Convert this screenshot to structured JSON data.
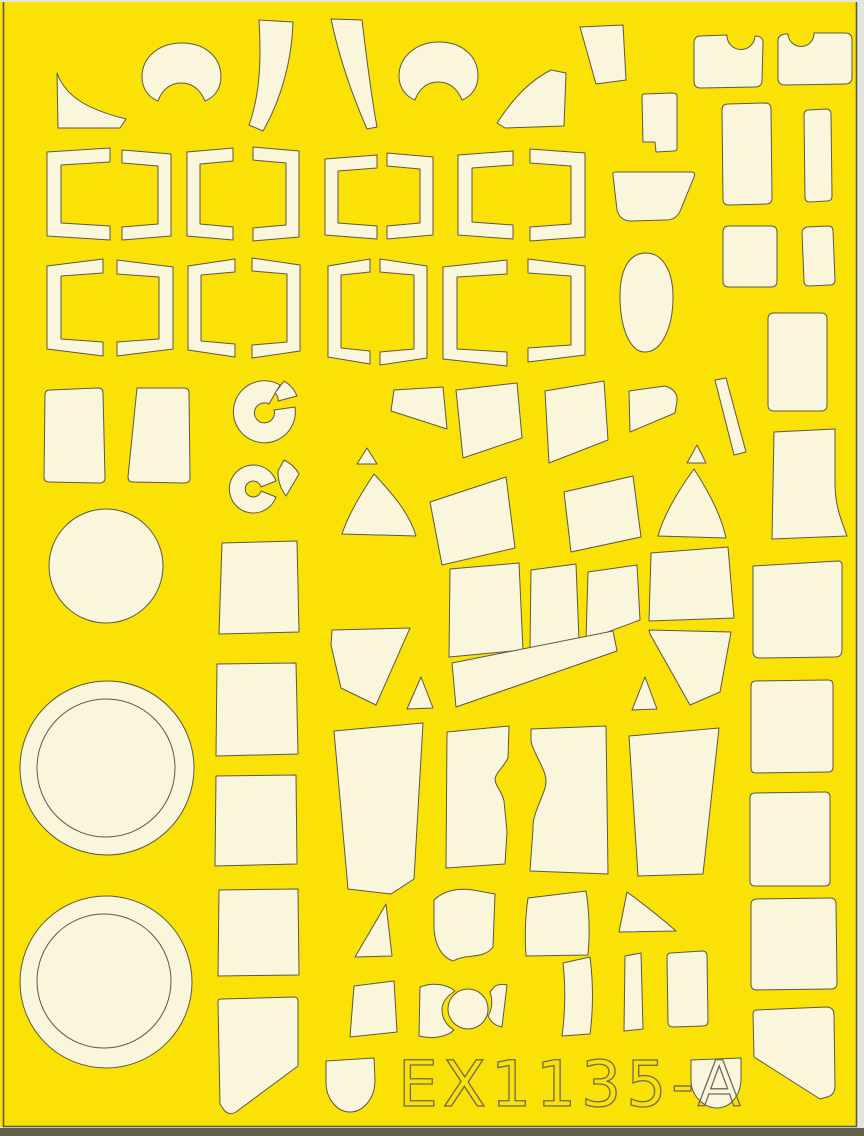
{
  "sheet": {
    "code": "EX1135-A"
  },
  "colors": {
    "scan_bg": "#E4E4E0",
    "sheet_yellow": "#FAE206",
    "mask_cream": "#FAF6DC",
    "outline": "#5C584A",
    "bottom_band": "#63614E",
    "text_outline": "#6E6A5C"
  },
  "label": {
    "x": 398,
    "y": 1106,
    "size": 63,
    "spacing": 5,
    "stroke_width": 1.3
  },
  "shapes": [
    {
      "name": "mask-fin-left",
      "d": "M57,73 C66,98 90,110 126,119 L120,128 L58,128 Z"
    },
    {
      "name": "mask-kidney-1",
      "d": "M142,77 C142,57 159,43 182,43 C205,43 221,57 221,77 C221,88 215,97 205,101 C200,89 192,83 181,83 C170,83 162,90 158,101 C148,97 142,88 142,77 Z"
    },
    {
      "name": "mask-crescent-1",
      "d": "M259,20 L293,22 C292,60 281,100 263,131 L249,125 C261,92 261,55 259,20 Z"
    },
    {
      "name": "mask-crescent-2",
      "d": "M331,19 L362,20 C367,62 372,100 377,127 L367,129 C353,97 339,57 331,19 Z"
    },
    {
      "name": "mask-kidney-2",
      "d": "M399,76 C399,57 416,42 439,42 C462,42 478,56 478,76 C478,87 472,96 462,100 C457,88 449,82 438,82 C427,82 419,89 415,100 C405,96 399,87 399,76 Z"
    },
    {
      "name": "mask-fin-right",
      "d": "M497,123 C516,94 533,79 551,70 L566,73 L564,126 L505,128 Z"
    },
    {
      "name": "mask-trapezoid-tr",
      "d": "M580,27 L623,25 L626,80 L596,84 Z"
    },
    {
      "name": "mask-notch-rect-1",
      "d": "M701,36 L727,35 A14,14 0 0 0 755,36 Q763,36 763,43 L762,80 Q762,87 755,87 L701,88 Q694,88 694,81 L694,43 Q694,36 701,36 Z"
    },
    {
      "name": "mask-notch-rect-2",
      "d": "M785,34 Q778,35 778,41 L778,78 Q778,85 785,85 L845,84 Q852,84 852,77 L852,40 Q852,33 845,33 L814,33 A13,13 0 0 1 788,34 Z"
    },
    {
      "name": "mask-rect-notch",
      "d": "M644,94 L672,93 Q677,93 677,96 L677,148 Q677,151 674,151 L656,152 L655,142 L643,142 L642,97 Q642,94 644,94 Z"
    },
    {
      "name": "mask-tall-rrect-1",
      "d": "M728,104 Q722,104 722,110 L723,199 Q723,205 729,205 L766,204 Q772,204 772,198 L771,109 Q771,103 765,103 Z"
    },
    {
      "name": "mask-narrow-rrect-1",
      "d": "M809,110 Q804,110 804,115 L805,197 Q805,202 810,202 L827,201 Q832,201 832,196 L831,114 Q831,109 826,109 Z"
    },
    {
      "name": "mask-trapezoid-mid",
      "d": "M613,175 Q612,172 616,172 L691,172 Q696,172 694,177 L681,209 Q677,220 666,220 L631,221 Q620,221 617,210 Z"
    },
    {
      "name": "mask-rsquare-1",
      "d": "M729,226 Q723,226 723,232 L723,281 Q723,287 729,287 L771,287 Q777,287 777,281 L777,232 Q777,226 771,226 Z"
    },
    {
      "name": "mask-narrow-rrect-2",
      "d": "M807,227 Q802,228 802,233 L804,281 Q804,286 809,286 L830,285 Q835,285 835,280 L833,231 Q833,226 828,226 Z"
    },
    {
      "name": "mask-egg",
      "d": "M646,253 C662,253 673,270 673,297 C673,327 662,352 645,352 C629,352 620,326 620,296 C620,268 630,253 646,253 Z"
    },
    {
      "name": "mask-big-rrect-right",
      "d": "M774,313 Q768,313 768,319 L768,405 Q768,411 774,411 L821,411 Q827,411 827,405 L827,319 Q827,313 821,313 Z"
    },
    {
      "name": "mask-rtrap-1",
      "d": "M50,390 Q45,390 45,395 L44,477 Q44,482 49,482 L99,483 Q105,483 105,478 L103,393 Q103,388 98,388 Z"
    },
    {
      "name": "mask-rtrap-2",
      "d": "M137,388 L184,388 Q189,388 189,393 L190,478 Q190,483 184,483 L133,482 Q128,482 128,477 Z"
    },
    {
      "name": "mask-spinner1-ring",
      "d": "M295,407 A31,31 0 1 1 280,385 L269,404 A10,10 0 1 0 274,410 Z"
    },
    {
      "name": "mask-spinner1-wedge",
      "d": "M284,381 A30,30 0 0 1 297,396 L278,401 A9,9 0 0 0 275,393 Z"
    },
    {
      "name": "mask-spinner2-ring",
      "d": "M276,497 A24,24 0 1 1 276,481 L261,487 A8,8 0 1 0 261,491 Z"
    },
    {
      "name": "mask-spinner2-wedge",
      "d": "M284,460 A34,34 0 0 1 299,474 L286,496 A40,40 0 0 1 278,471 Z"
    },
    {
      "name": "mask-square-1",
      "d": "M222,543 L297,541 L299,632 L219,634 Z"
    },
    {
      "name": "mask-square-2",
      "d": "M217,664 L296,663 L298,754 L216,756 Z"
    },
    {
      "name": "mask-square-3",
      "d": "M216,776 L296,775 L297,864 L215,866 Z"
    },
    {
      "name": "mask-square-4",
      "d": "M219,890 L298,889 L299,975 L218,976 Z"
    },
    {
      "name": "mask-pennant-left",
      "d": "M221,999 L294,997 Q298,997 298,1001 L298,1066 L236,1112 Q229,1116 224,1110 L220,1104 L218,1002 Q218,999 221,999 Z"
    },
    {
      "name": "mask-poly-flag",
      "d": "M391,411 L394,390 L443,387 L447,429 Z"
    },
    {
      "name": "mask-poly-a",
      "d": "M456,390 L517,383 L522,438 L463,458 Z"
    },
    {
      "name": "mask-poly-b",
      "d": "M545,391 L604,381 L608,440 L549,463 Z"
    },
    {
      "name": "mask-tri-1",
      "d": "M367,448 L377,464 L357,464 Z"
    },
    {
      "name": "mask-cone-1",
      "d": "M374,474 C362,492 348,515 342,534 L416,536 C409,512 390,491 374,474 Z"
    },
    {
      "name": "mask-poly-c",
      "d": "M430,502 L506,477 L515,548 L442,565 Z"
    },
    {
      "name": "mask-poly-d",
      "d": "M564,492 L633,476 L641,537 L571,552 Z"
    },
    {
      "name": "mask-tri-2",
      "d": "M697,445 L706,463 L687,463 Z"
    },
    {
      "name": "mask-cone-2",
      "d": "M694,469 C680,488 664,514 658,536 L726,538 C721,514 707,489 694,469 Z"
    },
    {
      "name": "mask-wedge-right",
      "d": "M629,391 L665,386 Q678,390 677,401 L675,413 L630,432 Z"
    },
    {
      "name": "mask-sliver-diagonal",
      "d": "M715,380 L726,378 L746,452 L734,455 Z"
    },
    {
      "name": "mask-boot",
      "d": "M774,432 L835,429 L835,483 C835,507 842,522 847,536 L772,539 Z"
    },
    {
      "name": "mask-quad-a",
      "d": "M450,569 L519,563 L523,650 L449,657 Z"
    },
    {
      "name": "mask-quad-b",
      "d": "M531,570 L576,564 L579,640 L530,648 Z"
    },
    {
      "name": "mask-quad-c",
      "d": "M588,572 L637,565 L640,620 L586,640 Z"
    },
    {
      "name": "mask-quad-d",
      "d": "M651,553 L728,547 L734,618 L649,621 Z"
    },
    {
      "name": "mask-band-e",
      "d": "M452,663 L613,631 L617,651 L456,707 Z"
    },
    {
      "name": "mask-pentagon-left",
      "d": "M332,630 L410,628 L376,705 L341,688 L331,645 Z"
    },
    {
      "name": "mask-tri-3",
      "d": "M421,677 L433,708 L407,709 Z"
    },
    {
      "name": "mask-pentagon-right",
      "d": "M649,630 L731,632 L720,692 L690,705 L650,634 Z"
    },
    {
      "name": "mask-tri-4",
      "d": "M645,677 L657,709 L632,710 Z"
    },
    {
      "name": "mask-bigquad-1",
      "d": "M334,731 L423,723 L414,879 L391,894 L348,889 Z"
    },
    {
      "name": "mask-waist-1",
      "d": "M447,732 L509,726 L508,758 C503,768 496,772 495,779 C495,786 502,791 504,801 L507,832 L505,864 L446,868 Z"
    },
    {
      "name": "mask-waist-2",
      "d": "M531,729 L606,726 L608,874 L530,871 L533,829 C532,812 546,794 546,781 C546,769 533,753 531,741 Z"
    },
    {
      "name": "mask-bigquad-2",
      "d": "M629,736 L719,728 L703,874 L638,876 Z"
    },
    {
      "name": "mask-rsq-a",
      "d": "M753,566 L838,561 Q842,561 842,565 L842,650 Q842,657 835,657 L760,658 Q753,658 753,651 Z"
    },
    {
      "name": "mask-rsq-b",
      "d": "M756,681 Q751,681 751,686 L751,768 Q751,773 756,773 L828,772 Q833,772 833,767 L833,685 Q833,680 828,680 Z"
    },
    {
      "name": "mask-rsq-c",
      "d": "M755,793 Q750,793 750,798 L750,881 Q750,886 755,886 L825,886 Q830,886 830,881 L830,797 Q830,792 825,792 Z"
    },
    {
      "name": "mask-tri-b1",
      "d": "M386,904 L392,956 L355,957 Z"
    },
    {
      "name": "mask-quad-b1",
      "d": "M434,900 C444,890 459,888 473,890 L495,894 L493,947 C483,960 467,953 453,961 C441,957 435,944 434,929 Z"
    },
    {
      "name": "mask-quad-b2",
      "d": "M528,898 L586,891 Q591,922 588,955 L526,956 Q524,925 528,898 Z"
    },
    {
      "name": "mask-tri-b2",
      "d": "M627,892 C642,903 660,917 676,931 L619,932 Z"
    },
    {
      "name": "mask-quad-b3",
      "d": "M354,986 L394,981 L397,1032 L350,1037 Z"
    },
    {
      "name": "mask-bite-left",
      "d": "M420,987 C432,982 447,984 455,991 C447,996 442,1002 442,1010 C442,1018 446,1025 454,1030 C446,1038 430,1039 419,1036 Z"
    },
    {
      "name": "mask-bite-right",
      "d": "M495,986 C500,984 504,984 507,985 L502,1027 C496,1026 491,1022 488,1016 C492,1010 493,1000 490,992 Z"
    },
    {
      "name": "mask-strip-vertical",
      "d": "M625,956 L641,953 L643,1029 L624,1031 Z"
    },
    {
      "name": "mask-rquad-b",
      "d": "M671,953 Q667,953 667,957 L668,1022 Q668,1027 673,1027 L703,1026 Q708,1026 708,1021 L707,956 Q707,951 702,951 L671,953 Z"
    },
    {
      "name": "mask-curved-quad",
      "d": "M563,963 L590,957 Q595,997 590,1034 L562,1036 Q567,999 563,963 Z"
    },
    {
      "name": "mask-big-rsq-br",
      "d": "M757,899 Q751,899 751,905 L751,984 Q751,990 757,990 L831,989 Q837,989 837,983 L836,904 Q836,898 830,898 Z"
    },
    {
      "name": "mask-pennant-right",
      "d": "M757,1010 L826,1007 Q834,1007 834,1015 L835,1086 Q835,1095 827,1097 L820,1099 L754,1057 L753,1014 Q753,1010 757,1010 Z"
    },
    {
      "name": "mask-dome-1",
      "d": "M326,1061 L374,1058 L375,1080 C375,1100 362,1112 350,1112 C338,1112 326,1100 326,1082 Z"
    },
    {
      "name": "mask-dome-2",
      "d": "M691,1060 L741,1058 L741,1078 C741,1097 729,1108 717,1108 C704,1108 691,1096 691,1080 Z"
    }
  ],
  "circles": [
    {
      "name": "mask-circle-small",
      "cx": 106,
      "cy": 566,
      "r": 57,
      "stroke_only": false
    },
    {
      "name": "mask-ring-1-outer",
      "cx": 107,
      "cy": 768,
      "r": 87,
      "stroke_only": false
    },
    {
      "name": "mask-ring-1-inner",
      "cx": 106,
      "cy": 768,
      "r": 69,
      "stroke_only": true
    },
    {
      "name": "mask-ring-2-outer",
      "cx": 106,
      "cy": 982,
      "r": 86,
      "stroke_only": false
    },
    {
      "name": "mask-ring-2-inner",
      "cx": 104,
      "cy": 981,
      "r": 67,
      "stroke_only": true
    },
    {
      "name": "mask-bite-circle",
      "cx": 468,
      "cy": 1009,
      "r": 20,
      "stroke_only": false
    }
  ],
  "brackets": [
    {
      "name": "mask-frame-1",
      "x": 47,
      "y": 148,
      "w": 63,
      "h": 92,
      "t": 14,
      "flip": false,
      "s": 4
    },
    {
      "name": "mask-frame-2",
      "x": 122,
      "y": 150,
      "w": 49,
      "h": 90,
      "t": 13,
      "flip": true,
      "s": 4
    },
    {
      "name": "mask-frame-3",
      "x": 187,
      "y": 148,
      "w": 46,
      "h": 92,
      "t": 13,
      "flip": false,
      "s": 4
    },
    {
      "name": "mask-frame-4",
      "x": 253,
      "y": 147,
      "w": 46,
      "h": 94,
      "t": 13,
      "flip": true,
      "s": 4
    },
    {
      "name": "mask-frame-5",
      "x": 325,
      "y": 155,
      "w": 52,
      "h": 84,
      "t": 13,
      "flip": false,
      "s": 4
    },
    {
      "name": "mask-frame-6",
      "x": 387,
      "y": 153,
      "w": 46,
      "h": 86,
      "t": 13,
      "flip": true,
      "s": 4
    },
    {
      "name": "mask-frame-7",
      "x": 458,
      "y": 151,
      "w": 55,
      "h": 88,
      "t": 14,
      "flip": false,
      "s": 4
    },
    {
      "name": "mask-frame-8",
      "x": 530,
      "y": 149,
      "w": 55,
      "h": 92,
      "t": 14,
      "flip": true,
      "s": 4
    },
    {
      "name": "mask-frame-9",
      "x": 47,
      "y": 259,
      "w": 56,
      "h": 97,
      "t": 14,
      "flip": false,
      "s": 7
    },
    {
      "name": "mask-frame-10",
      "x": 117,
      "y": 260,
      "w": 56,
      "h": 96,
      "t": 14,
      "flip": true,
      "s": 7
    },
    {
      "name": "mask-frame-11",
      "x": 188,
      "y": 259,
      "w": 47,
      "h": 98,
      "t": 13,
      "flip": false,
      "s": 7
    },
    {
      "name": "mask-frame-12",
      "x": 252,
      "y": 258,
      "w": 48,
      "h": 100,
      "t": 13,
      "flip": true,
      "s": 7
    },
    {
      "name": "mask-frame-13",
      "x": 328,
      "y": 259,
      "w": 42,
      "h": 105,
      "t": 13,
      "flip": false,
      "s": 7
    },
    {
      "name": "mask-frame-14",
      "x": 380,
      "y": 259,
      "w": 47,
      "h": 106,
      "t": 13,
      "flip": true,
      "s": 7
    },
    {
      "name": "mask-frame-15",
      "x": 443,
      "y": 260,
      "w": 64,
      "h": 106,
      "t": 14,
      "flip": false,
      "s": 7
    },
    {
      "name": "mask-frame-16",
      "x": 528,
      "y": 259,
      "w": 57,
      "h": 103,
      "t": 14,
      "flip": true,
      "s": 7
    }
  ]
}
